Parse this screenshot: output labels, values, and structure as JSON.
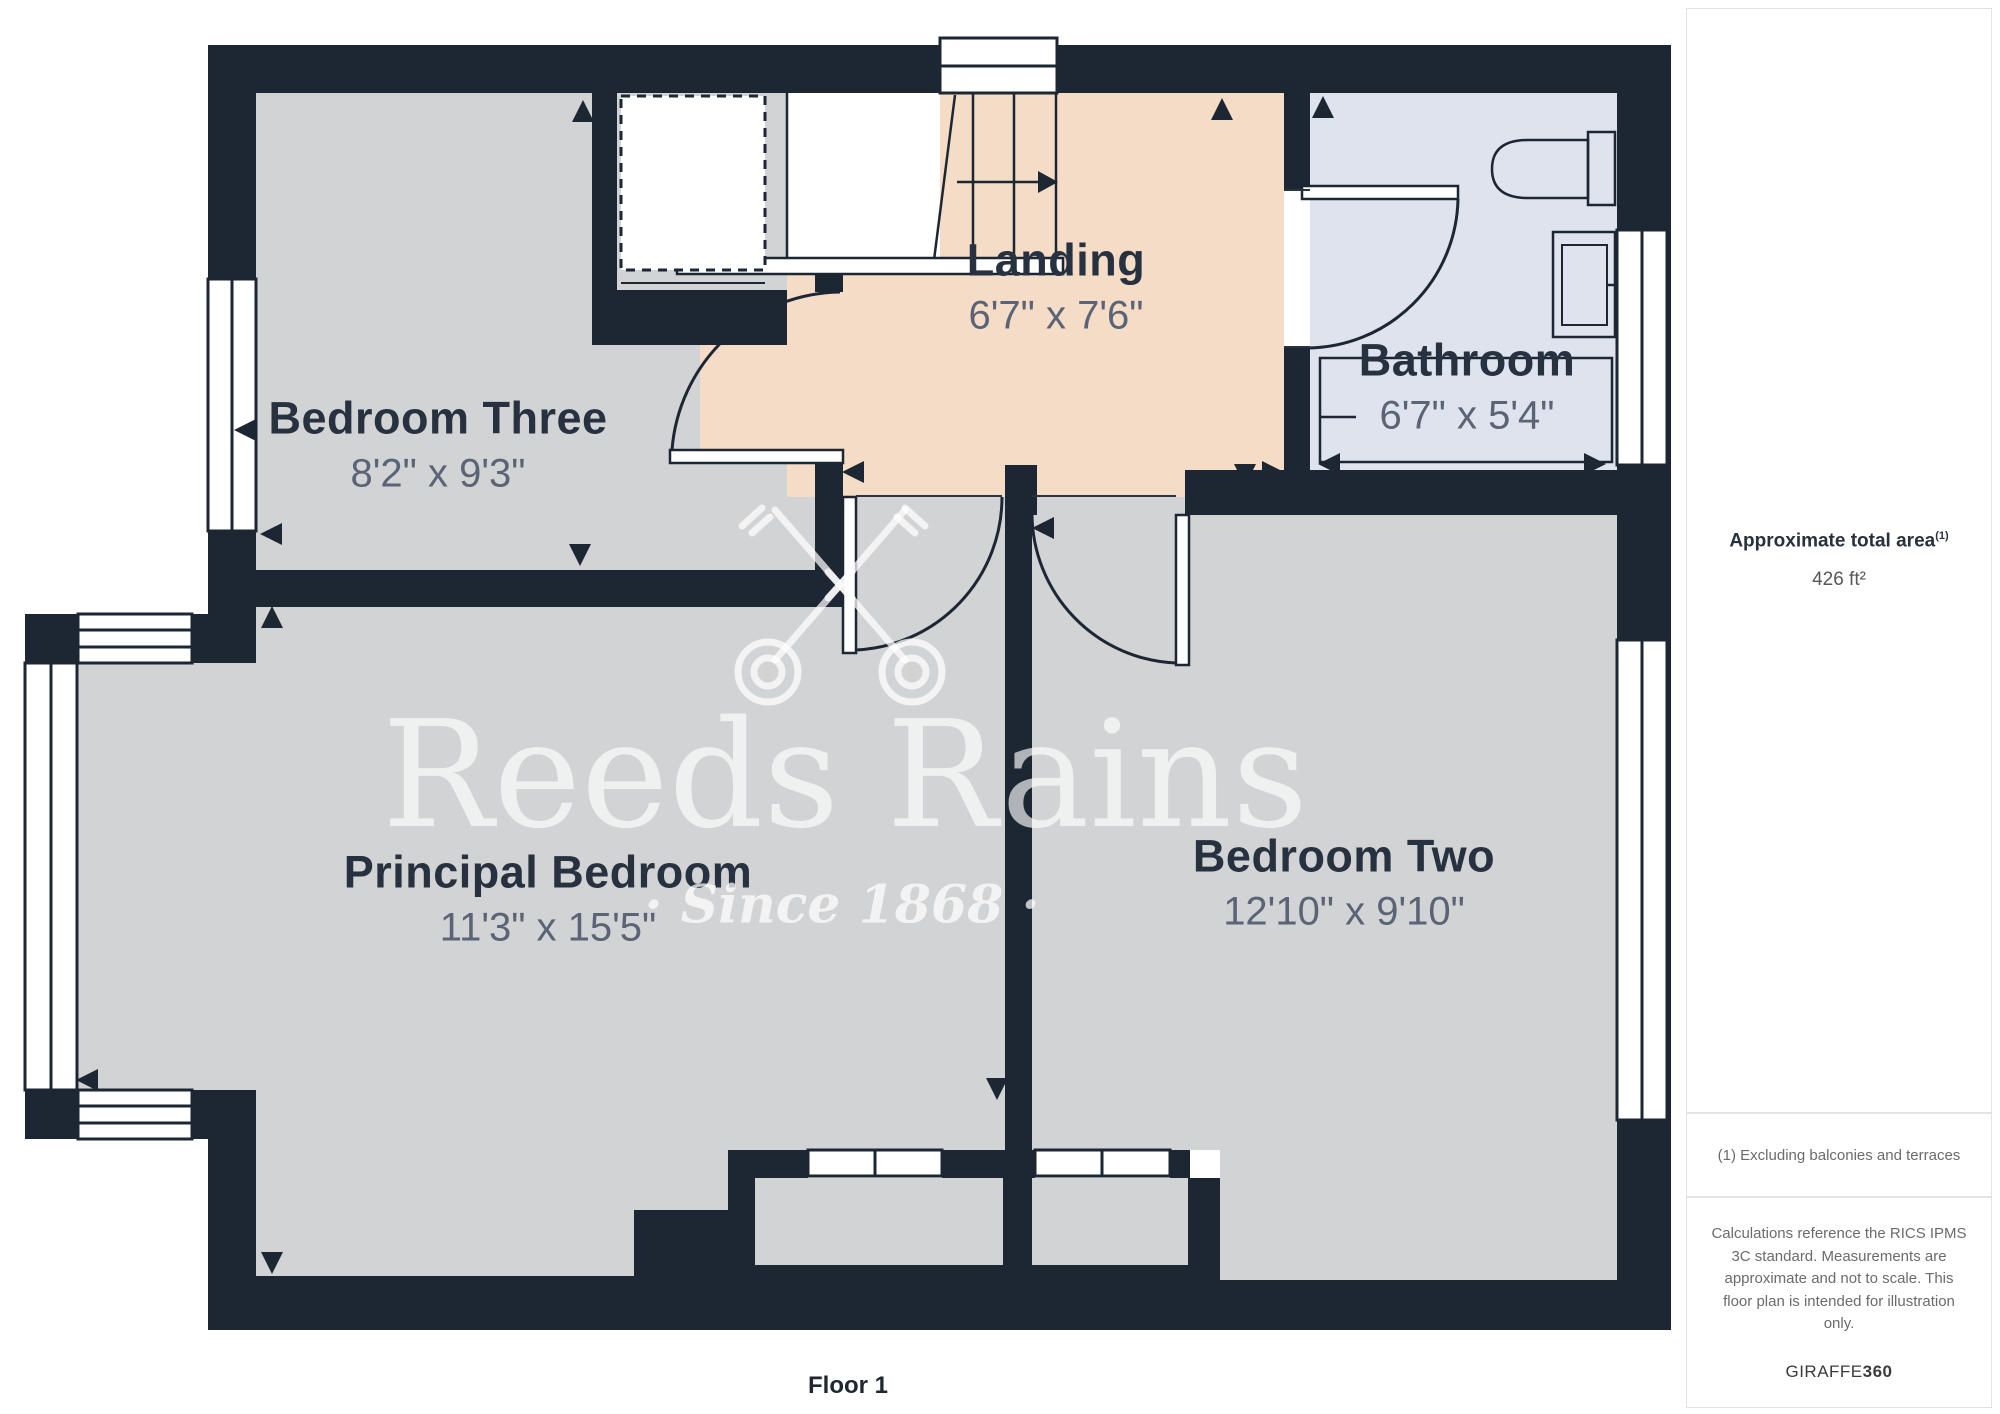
{
  "plan": {
    "floor_label": "Floor 1",
    "rooms": [
      {
        "name": "Bedroom Three",
        "dims": "8'2\" x 9'3\""
      },
      {
        "name": "Landing",
        "dims": "6'7\" x 7'6\""
      },
      {
        "name": "Bathroom",
        "dims": "6'7\" x 5'4\""
      },
      {
        "name": "Principal Bedroom",
        "dims": "11'3\" x 15'5\""
      },
      {
        "name": "Bedroom Two",
        "dims": "12'10\" x 9'10\""
      }
    ]
  },
  "watermark": {
    "brand": "Reeds Rains",
    "tagline": "· Since 1868 ·"
  },
  "sidebar": {
    "area_title": "Approximate total area",
    "area_note_marker": "(1)",
    "area_value": "426 ft²",
    "footnote": "(1) Excluding balconies and terraces",
    "disclaimer": "Calculations reference the RICS IPMS 3C standard. Measurements are approximate and not to scale. This floor plan is intended for illustration only.",
    "brand_prefix": "GIRAFFE",
    "brand_suffix": "360"
  },
  "colors": {
    "wall": "#1d2633",
    "room_fill": "#d2d3d5",
    "landing_fill": "#f5dcc7",
    "bathroom_fill": "#dfe3ee",
    "label_text": "#273140",
    "dims_text": "#5b6476"
  }
}
